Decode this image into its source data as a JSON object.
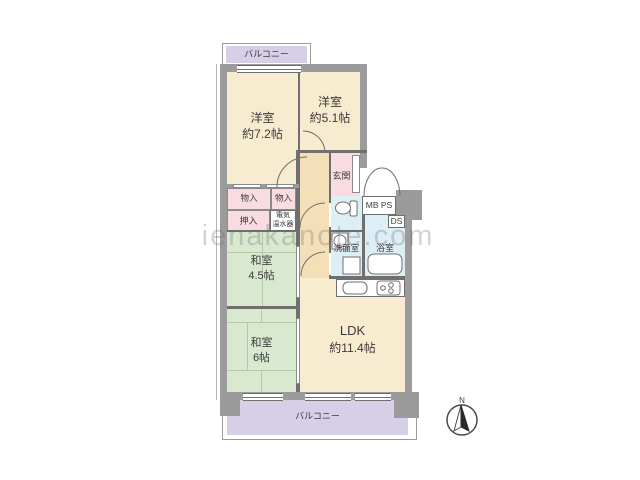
{
  "watermark": "ienakanote.com",
  "compass": {
    "north_label": "N"
  },
  "balconies": {
    "top": "バルコニー",
    "bottom": "バルコニー"
  },
  "rooms": {
    "western_7_2": {
      "name": "洋室",
      "size": "約7.2帖"
    },
    "western_5_1": {
      "name": "洋室",
      "size": "約5.1帖"
    },
    "japanese_4_5": {
      "name": "和室",
      "size": "4.5帖"
    },
    "japanese_6": {
      "name": "和室",
      "size": "6帖"
    },
    "ldk": {
      "name": "LDK",
      "size": "約11.4帖"
    },
    "entrance": "玄関",
    "washroom": "洗面室",
    "bathroom": "浴室"
  },
  "storage": {
    "storage_1": "物入",
    "storage_2": "物入",
    "closet": "押入",
    "water_heater": [
      "電気",
      "温水器"
    ]
  },
  "shafts": {
    "meter_pipe": "MB PS",
    "duct": "DS"
  },
  "colors": {
    "wall_gray": "#9b9b9b",
    "line_gray": "#6f6f6f",
    "room_cream": "#f8ecd0",
    "hall_tan": "#f4dfb8",
    "tatami_green": "#d8e9d0",
    "storage_pink": "#f9dbe2",
    "wet_blue": "#dceef6",
    "balcony_lavender": "#d7cfe7"
  }
}
